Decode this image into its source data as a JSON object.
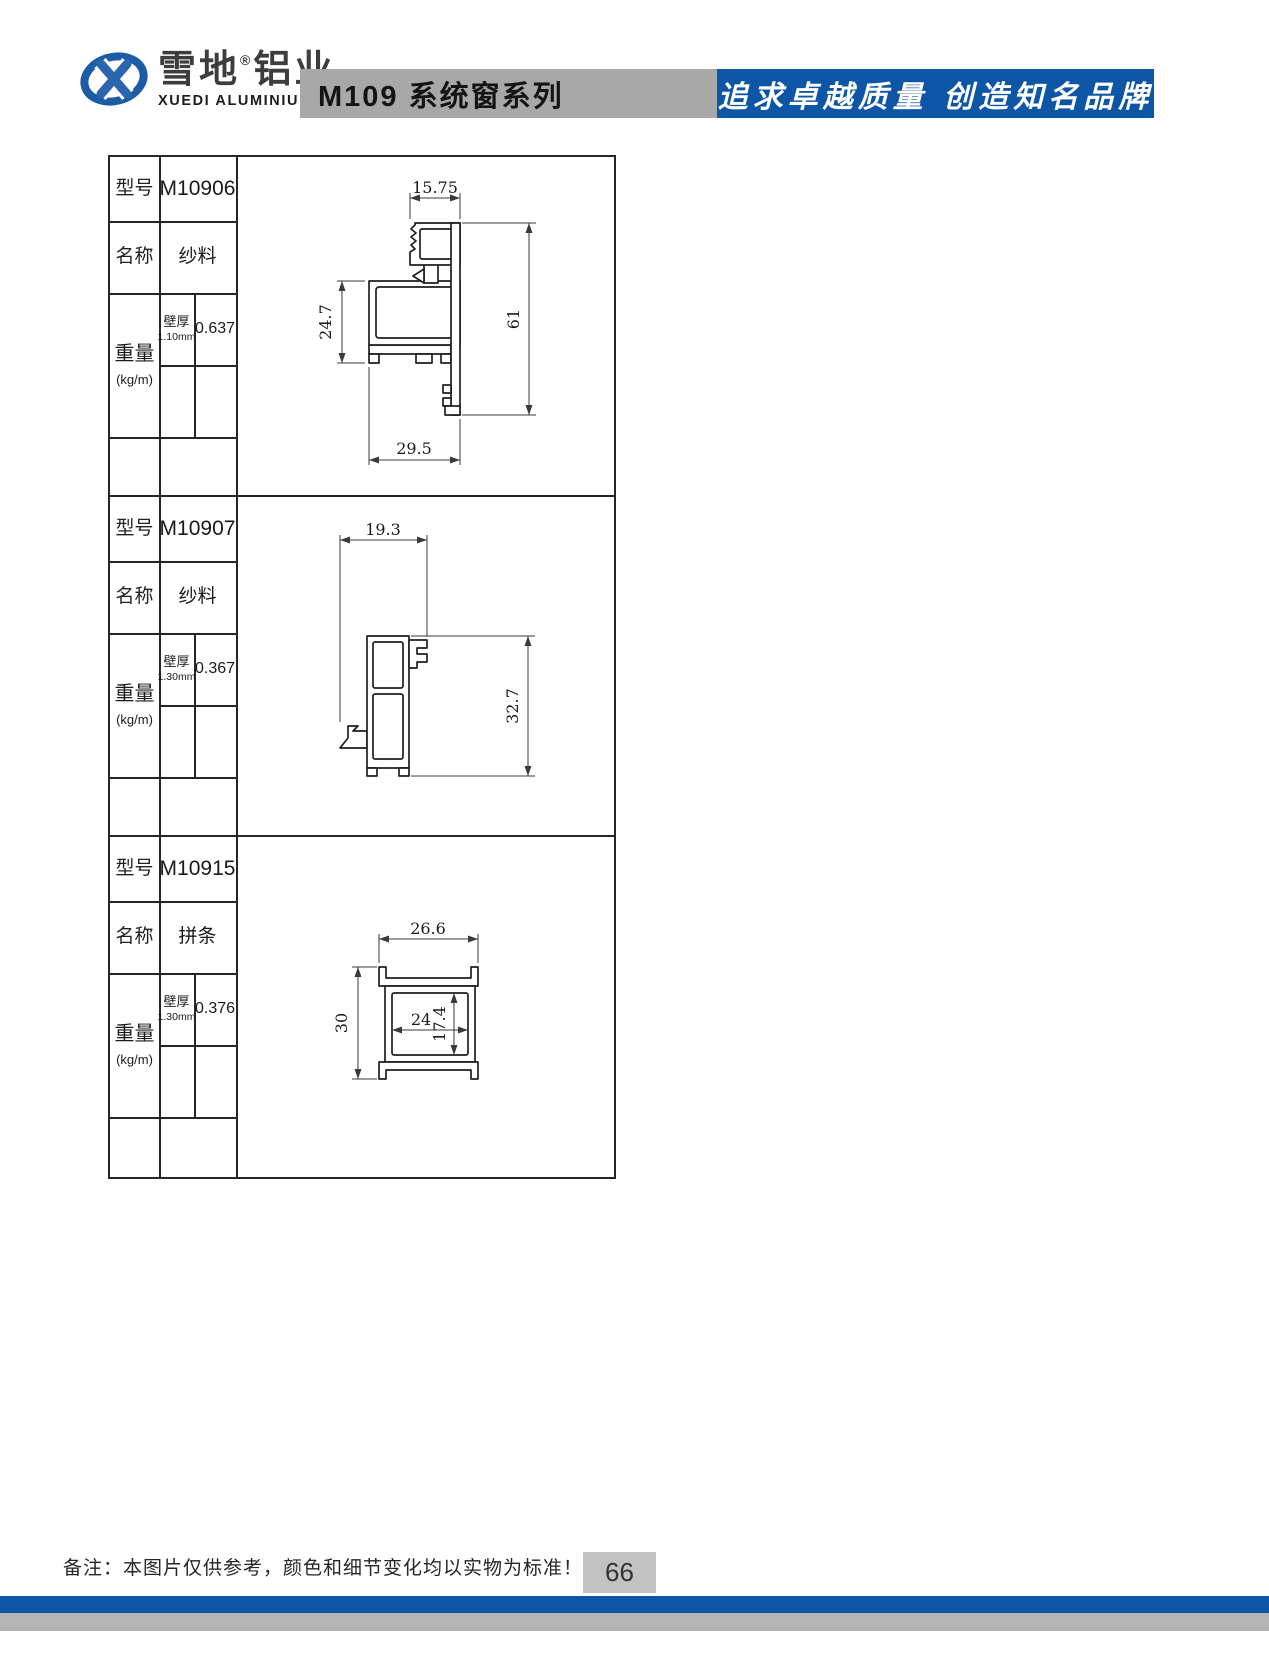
{
  "header": {
    "brand_cn_1": "雪地",
    "brand_reg": "®",
    "brand_cn_2": "铝业",
    "brand_en": "XUEDI ALUMINIUM",
    "series_title": "M109 系统窗系列",
    "slogan": "追求卓越质量 创造知名品牌",
    "colors": {
      "band_gray": "#a8a8a8",
      "band_blue": "#0d55a5"
    }
  },
  "table": {
    "row_labels": {
      "model": "型号",
      "name": "名称",
      "weight": "重量",
      "weight_unit": "(kg/m)",
      "wall_thickness": "壁厚"
    },
    "blocks": [
      {
        "model": "M10906",
        "name": "纱料",
        "wall_thickness": "1.10mm",
        "weight_value": "0.637",
        "dims": {
          "top_width": "15.75",
          "left_height": "24.7",
          "right_height": "61",
          "bottom_width": "29.5"
        }
      },
      {
        "model": "M10907",
        "name": "纱料",
        "wall_thickness": "1.30mm",
        "weight_value": "0.367",
        "dims": {
          "top_width": "19.3",
          "right_height": "32.7"
        }
      },
      {
        "model": "M10915",
        "name": "拼条",
        "wall_thickness": "1.30mm",
        "weight_value": "0.376",
        "dims": {
          "top_width": "26.6",
          "left_height": "30",
          "inner_width": "24",
          "inner_height": "17.4"
        }
      }
    ]
  },
  "footer": {
    "note": "备注：本图片仅供参考，颜色和细节变化均以实物为标准！",
    "page_number": "66"
  }
}
